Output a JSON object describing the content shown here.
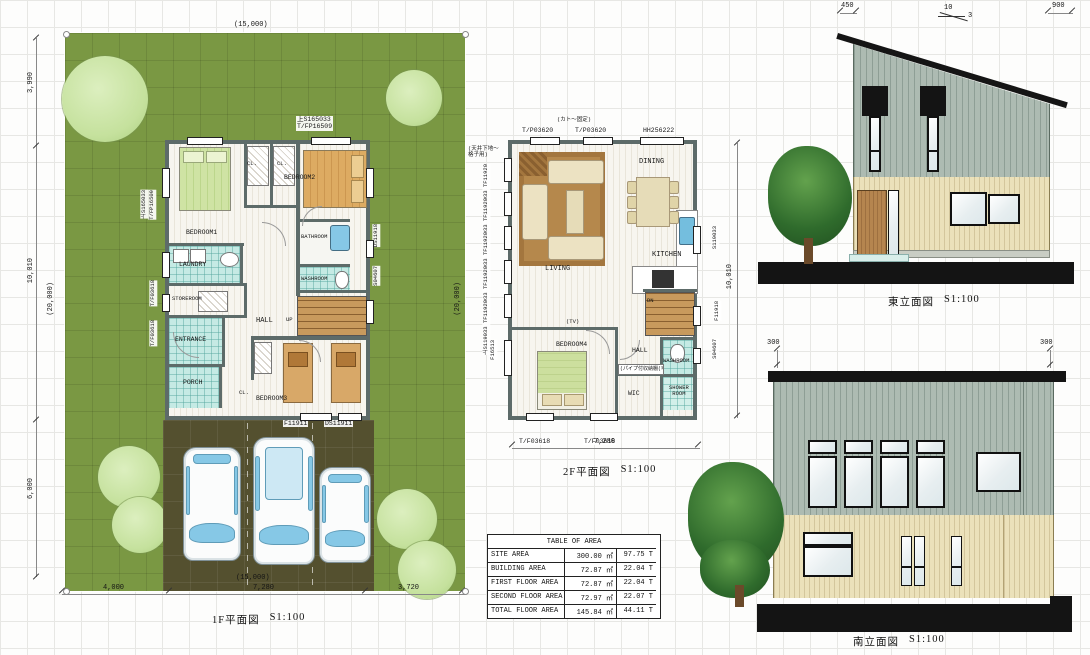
{
  "plan1f": {
    "title": "1F平面図",
    "scale": "S1:100",
    "dim_top": "(15,000)",
    "dim_bottom_overall": "(15,000)",
    "dim_bottom": [
      "4,000",
      "7,280",
      "3,720"
    ],
    "dim_left": [
      "3,990",
      "10,010",
      "6,000"
    ],
    "dim_left_overall": "(20,000)",
    "dim_right_overall": "(20,000)",
    "rooms": {
      "bedroom1": "BEDROOM1",
      "bedroom2": "BEDROOM2",
      "cl1": "CL.",
      "cl2": "CL.",
      "cl3": "CL.",
      "bathroom": "BATHROOM",
      "washroom": "WASHROOM",
      "laundry": "LAUNDRY",
      "storeroom": "STOREROOM",
      "entrance": "ENTRANCE",
      "porch": "PORCH",
      "hall": "HALL",
      "bedroom3": "BEDROOM3",
      "up": "UP"
    },
    "codes": {
      "top_a": "上S165033",
      "top_b": "T/FP16509",
      "left_a": "上S165033",
      "left_b": "T/FP16509",
      "left_c": "T/F03618",
      "left_d": "T/F03618",
      "right_a": "DS11918",
      "right_b": "S04607",
      "bottom_a": "F11911",
      "bottom_b": "DS11911"
    }
  },
  "plan2f": {
    "title": "2F平面図",
    "scale": "S1:100",
    "dim_bottom": "7,280",
    "dim_right": "10,010",
    "rooms": {
      "living": "LIVING",
      "dining": "DINING",
      "kitchen": "KITCHEN",
      "bedroom4": "BEDROOM4",
      "hall": "HALL",
      "washroom": "WASHROOM",
      "wic": "WIC",
      "shower1": "SHOWER",
      "shower2": "ROOM",
      "dn": "DN",
      "tv": "(TV)"
    },
    "codes": {
      "top_a": "T/P03620",
      "top_b": "T/P03620",
      "top_c": "HH256222",
      "top_note": "(カト〜固定)",
      "left_note1": "(天井下地〜",
      "left_note2": "格子用)",
      "left_rep": "上S119033 TF11920",
      "left_f": "F16513",
      "right_a": "S119033",
      "right_b": "F11918",
      "right_c": "S04607",
      "bottom_a": "T/F03618",
      "bottom_b": "T/F03618",
      "wic_note": "(パイプ付収納棚(可動))"
    }
  },
  "elev_east": {
    "title": "東立面図",
    "scale": "S1:100",
    "dim_left": "450",
    "dim_right": "900",
    "slope_run": "10",
    "slope_rise": "3"
  },
  "elev_south": {
    "title": "南立面図",
    "scale": "S1:100",
    "dim_left": "300",
    "dim_right": "300"
  },
  "area_table": {
    "title": "TABLE OF AREA",
    "rows": [
      {
        "label": "SITE AREA",
        "m2": "300.00 ㎡",
        "t": "97.75 T"
      },
      {
        "label": "BUILDING AREA",
        "m2": "72.87 ㎡",
        "t": "22.04 T"
      },
      {
        "label": "FIRST FLOOR AREA",
        "m2": "72.87 ㎡",
        "t": "22.04 T"
      },
      {
        "label": "SECOND FLOOR AREA",
        "m2": "72.97 ㎡",
        "t": "22.07 T"
      },
      {
        "label": "TOTAL FLOOR AREA",
        "m2": "145.84 ㎡",
        "t": "44.11 T"
      }
    ]
  },
  "colors": {
    "lawn": "#7a9843",
    "driveway": "#54502f",
    "wall": "#5d6b69",
    "siding_gray": "#adbbb2",
    "siding_cream": "#ebe1ba",
    "water": "#86c8e6",
    "wood": "#c89a5d"
  }
}
